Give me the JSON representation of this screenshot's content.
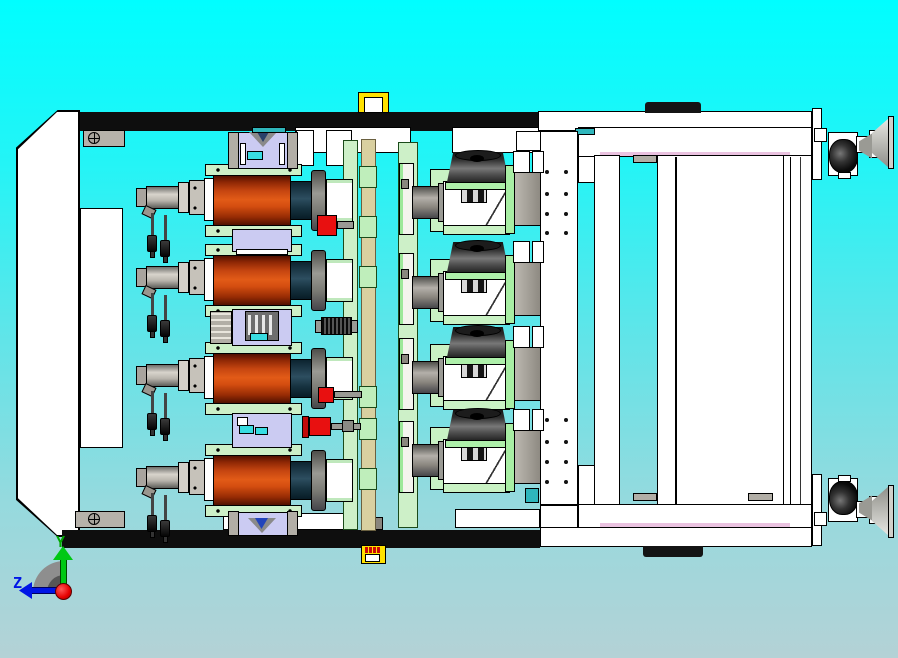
{
  "viewport": {
    "background": {
      "bg_top": "#00feff",
      "bg_bottom": "#b4d2d6"
    },
    "axis_triad": {
      "y_label": "Y",
      "z_label": "Z",
      "y_color": "#00a800",
      "z_color": "#0016e6",
      "origin_color": "#e60000"
    }
  },
  "machine": {
    "motor_count": 4,
    "turret_count": 4,
    "motor_rows_y": [
      175,
      255,
      353,
      455
    ],
    "turret_rows_y": [
      150,
      240,
      325,
      408
    ],
    "caster_y": [
      106,
      474
    ],
    "colors": {
      "motor_body": "#e25b17",
      "motor_cap": "#16323f",
      "mount_green": "#cdf0c8",
      "guide_lavender": "#cbcbf2",
      "rail_black": "#0e0e0e",
      "frame_white": "#ffffff",
      "sensor_yellow": "#ffe100",
      "coupler_red": "#e81010",
      "tan_plate": "#d9d0a0",
      "seal_pink": "#eac2e0"
    }
  }
}
